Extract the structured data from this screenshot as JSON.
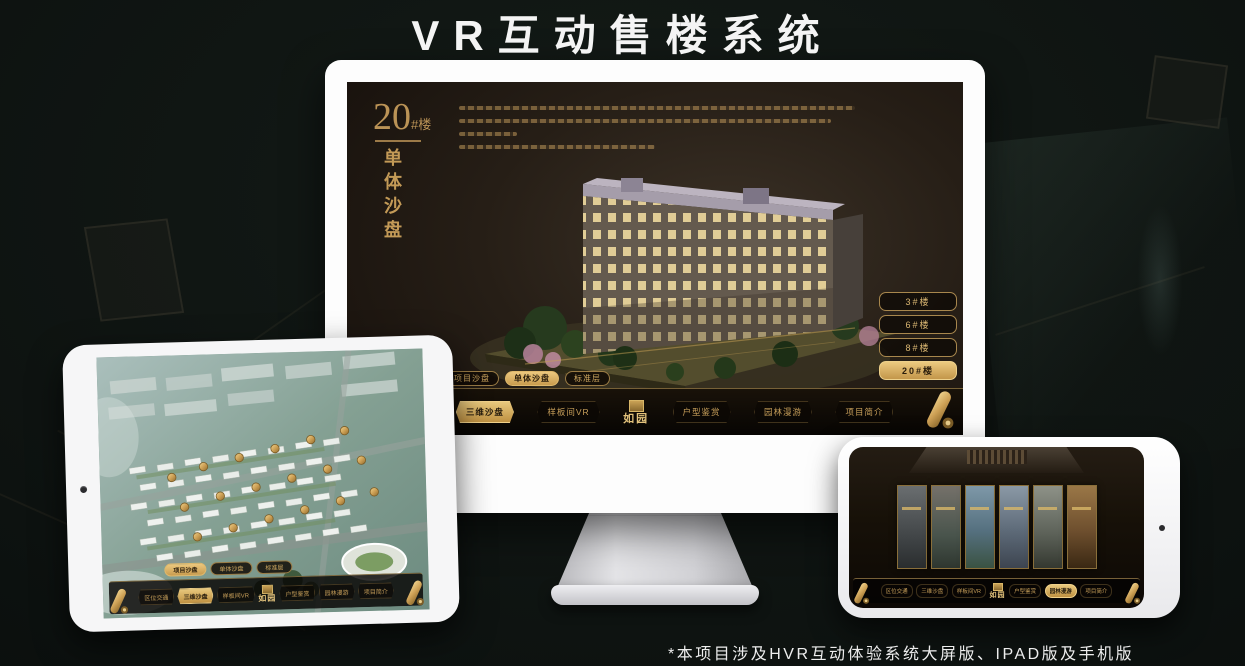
{
  "page": {
    "title": "VR互动售楼系统",
    "footnote": "*本项目涉及HVR互动体验系统大屏版、IPAD版及手机版"
  },
  "colors": {
    "gold": "#c8a35f",
    "gold_bright": "#e8c87d",
    "screen_dark": "#241e16",
    "background": "#0d1210"
  },
  "monitor": {
    "hero": {
      "number": "20",
      "suffix": "#楼",
      "vertical_title": "单体沙盘"
    },
    "floor_buttons": [
      {
        "label": "3#楼"
      },
      {
        "label": "6#楼"
      },
      {
        "label": "8#楼"
      },
      {
        "label": "20#楼"
      }
    ],
    "subtabs": [
      {
        "label": "项目沙盘"
      },
      {
        "label": "单体沙盘"
      },
      {
        "label": "标准层"
      }
    ],
    "nav": {
      "left": [
        {
          "label": "区位交通"
        },
        {
          "label": "三维沙盘"
        },
        {
          "label": "样板间VR"
        }
      ],
      "logo": "如园",
      "right": [
        {
          "label": "户型鉴赏"
        },
        {
          "label": "园林漫游"
        },
        {
          "label": "项目简介"
        }
      ]
    }
  },
  "tablet": {
    "subtabs": [
      {
        "label": "项目沙盘"
      },
      {
        "label": "单体沙盘"
      },
      {
        "label": "标准层"
      }
    ],
    "nav": {
      "left": [
        {
          "label": "区位交通"
        },
        {
          "label": "三维沙盘"
        },
        {
          "label": "样板间VR"
        }
      ],
      "logo": "如园",
      "right": [
        {
          "label": "户型鉴赏"
        },
        {
          "label": "园林漫游"
        },
        {
          "label": "项目简介"
        }
      ]
    }
  },
  "phone": {
    "nav": {
      "left": [
        {
          "label": "区位交通"
        },
        {
          "label": "三维沙盘"
        },
        {
          "label": "样板间VR"
        }
      ],
      "logo": "如园",
      "right": [
        {
          "label": "户型鉴赏"
        },
        {
          "label": "园林漫游"
        },
        {
          "label": "项目简介"
        }
      ]
    }
  }
}
